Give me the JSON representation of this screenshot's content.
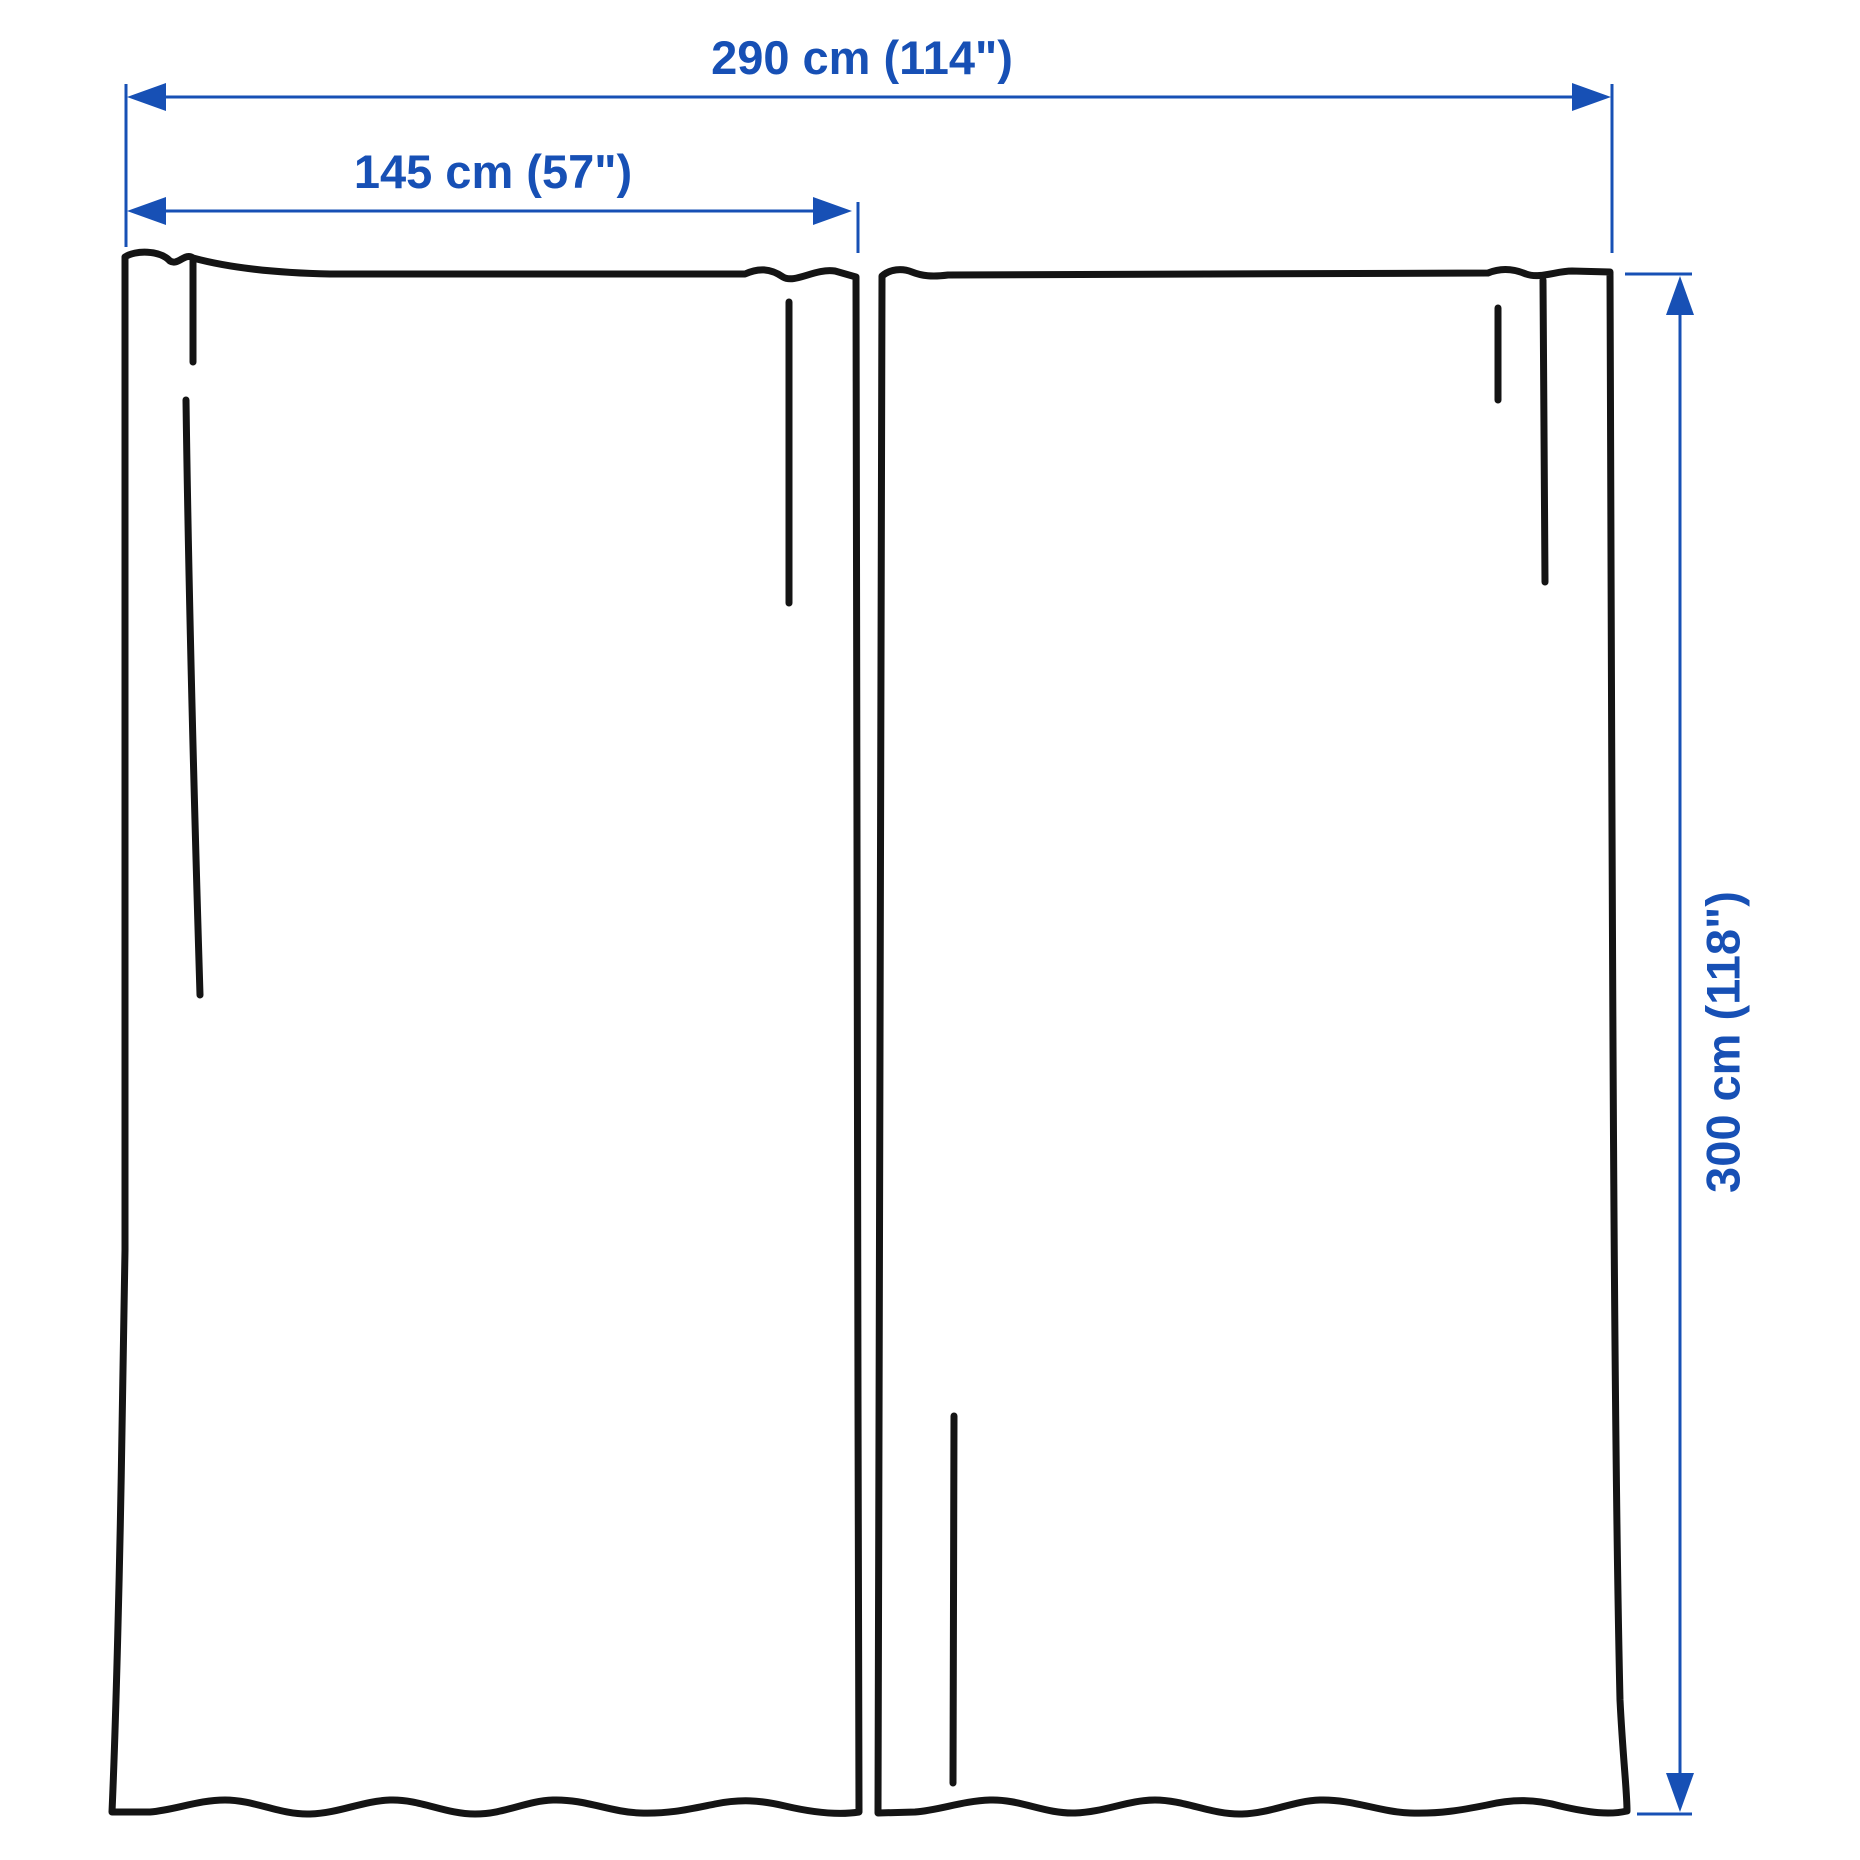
{
  "diagram": {
    "title": "Curtain pair measurement illustration",
    "labels": {
      "total_width": "290 cm (114\")",
      "panel_width": "145 cm (57\")",
      "panel_height": "300 cm (118\")"
    },
    "measurements": {
      "total_width": {
        "cm": 290,
        "inches": 114
      },
      "panel_width": {
        "cm": 145,
        "inches": 57
      },
      "panel_height": {
        "cm": 300,
        "inches": 118
      }
    },
    "colors": {
      "dimension_blue": "#1750b5",
      "outline_black": "#141414",
      "background": "#ffffff"
    }
  }
}
